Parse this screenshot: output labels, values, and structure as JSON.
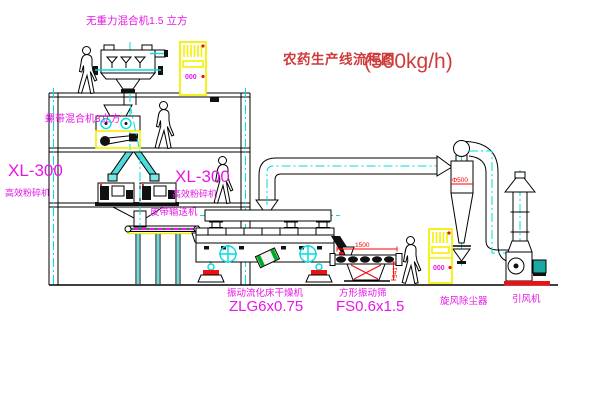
{
  "title": {
    "text": "农药生产线流程图",
    "capacity": "(500kg/h)"
  },
  "equipment": {
    "top_mixer": {
      "label": "无重力混合机1.5 立方"
    },
    "floor2_mixer": {
      "label": "螺带混合机3立方"
    },
    "mill_left": {
      "model": "XL-300",
      "name": "高效粉碎机"
    },
    "mill_center": {
      "model": "XL-300",
      "name": "高效粉碎机"
    },
    "belt_conveyor": {
      "label": "皮带输送机"
    },
    "dryer": {
      "name": "振动流化床干燥机",
      "model": "ZLG6x0.75"
    },
    "screen": {
      "name": "方形振动筛",
      "model": "FS0.6x1.5"
    },
    "cyclone": {
      "name": "旋风除尘器",
      "diameter_label": "Φ500"
    },
    "fan": {
      "name": "引风机"
    }
  },
  "dimensions": {
    "screen_length": "1500",
    "screen_height": "541"
  },
  "cabinet_display": "000",
  "colors": {
    "line": "#000000",
    "cad_cyan": "#00dede",
    "label_magenta": "#e617e6",
    "title_red": "#cd3b3b",
    "dim_red": "#ff0000",
    "cabinet_yellow": "#f2f200",
    "belt_green": "#00a800",
    "base_red": "#ee1111",
    "motor_teal": "#1ba8a0",
    "drum_green": "#00aa22"
  }
}
